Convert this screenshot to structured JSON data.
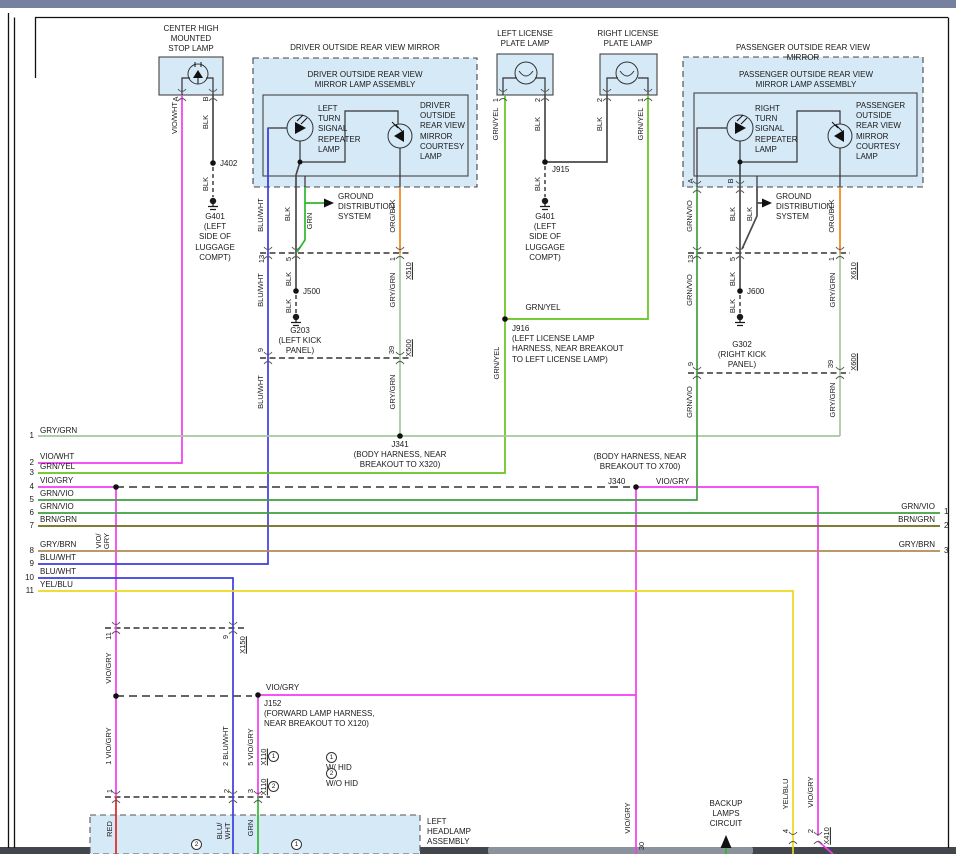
{
  "window": {
    "top_bar_color": "#76819f",
    "bottom_bar_color": "#42474e",
    "bottom_thumb_color": "#8b939d"
  },
  "colors": {
    "box_fill": "#d6e9f7",
    "box_border": "#444444"
  },
  "wire_colors": {
    "vio": "#f23cf2",
    "blk": "#4a4a4a",
    "blu_wht": "#3c3ce0",
    "grn": "#2eb82e",
    "grn_yel": "#64c41c",
    "gry_grn": "#a6c79e",
    "grn_vio": "#3f9f3f",
    "brn_grn": "#6b6b14",
    "gry_brn": "#b08a55",
    "yel_blu": "#ecd919",
    "org_blk": "#ef8318",
    "red": "#e32222",
    "dashed": "#333333",
    "internal": "#333333"
  },
  "components": {
    "chmsl_title": "CENTER HIGH\nMOUNTED\nSTOP LAMP",
    "driver_mirror_title": "DRIVER OUTSIDE REAR VIEW MIRROR",
    "driver_assembly_title": "DRIVER OUTSIDE REAR VIEW\nMIRROR LAMP ASSEMBLY",
    "left_turn_lamp": "LEFT\nTURN\nSIGNAL\nREPEATER\nLAMP",
    "driver_courtesy_lamp": "DRIVER\nOUTSIDE\nREAR VIEW\nMIRROR\nCOURTESY\nLAMP",
    "passenger_mirror_title": "PASSENGER OUTSIDE REAR VIEW MIRROR",
    "passenger_assembly_title": "PASSENGER OUTSIDE REAR VIEW\nMIRROR LAMP ASSEMBLY",
    "right_turn_lamp": "RIGHT\nTURN\nSIGNAL\nREPEATER\nLAMP",
    "passenger_courtesy_lamp": "PASSENGER\nOUTSIDE\nREAR VIEW\nMIRROR\nCOURTESY\nLAMP",
    "left_license_title": "LEFT LICENSE\nPLATE LAMP",
    "right_license_title": "RIGHT LICENSE\nPLATE LAMP",
    "left_headlamp_title": "LEFT\nHEADLAMP\nASSEMBLY",
    "backup_lamps": "BACKUP\nLAMPS\nCIRCUIT",
    "ground_distribution": "GROUND\nDISTRIBUTION\nSYSTEM"
  },
  "grounds": {
    "g401": "G401\n(LEFT\nSIDE OF\nLUGGAGE\nCOMPT)",
    "g203": "G203\n(LEFT KICK\nPANEL)",
    "g302": "G302\n(RIGHT KICK\nPANEL)"
  },
  "junctions": {
    "j402": "J402",
    "j915": "J915",
    "j500": "J500",
    "j600": "J600",
    "j916": "J916\n(LEFT LICENSE LAMP\nHARNESS, NEAR BREAKOUT\nTO LEFT LICENSE LAMP)",
    "j341": "J341\n(BODY HARNESS, NEAR\nBREAKOUT TO X320)",
    "j340_note": "(BODY HARNESS, NEAR\nBREAKOUT TO X700)",
    "j340": "J340",
    "j152": "J152\n(FORWARD LAMP HARNESS,\nNEAR BREAKOUT TO X120)"
  },
  "connectors": {
    "x510": "X510",
    "x500": "X500",
    "x610": "X610",
    "x600": "X600",
    "x150": "X150",
    "x110": "X110",
    "x410": "X410"
  },
  "wires": {
    "vio_wht": "VIO/WHT",
    "vio_gry": "VIO/GRY",
    "vio_gry_2l": "VIO/\nGRY",
    "blk": "BLK",
    "blu_wht": "BLU/WHT",
    "blu_wht_2l": "BLU/\nWHT",
    "grn": "GRN",
    "grn_yel": "GRN/YEL",
    "gry_grn": "GRY/GRN",
    "grn_vio": "GRN/VIO",
    "brn_grn": "BRN/GRN",
    "gry_brn": "GRY/BRN",
    "yel_blu": "YEL/BLU",
    "org_blk": "ORG/BLK",
    "red": "RED",
    "vio_gry_p1": "1  VIO/GRY",
    "blu_wht_p2": "2  BLU/WHT",
    "vio_gry_p5": "5  VIO/GRY"
  },
  "pins": {
    "a": "A",
    "b": "B",
    "p1": "1",
    "p2": "2",
    "p3": "3",
    "p4": "4",
    "p5": "5",
    "p9": "9",
    "p11": "11",
    "p13": "13",
    "p30": "30",
    "p39": "39"
  },
  "left_bus": [
    {
      "n": "1",
      "label": "GRY/GRN"
    },
    {
      "n": "2",
      "label": "VIO/WHT"
    },
    {
      "n": "3",
      "label": "GRN/YEL"
    },
    {
      "n": "4",
      "label": "VIO/GRY"
    },
    {
      "n": "5",
      "label": "GRN/VIO"
    },
    {
      "n": "6",
      "label": "GRN/VIO"
    },
    {
      "n": "7",
      "label": "BRN/GRN"
    },
    {
      "n": "8",
      "label": "GRY/BRN"
    },
    {
      "n": "9",
      "label": "BLU/WHT"
    },
    {
      "n": "10",
      "label": "BLU/WHT"
    },
    {
      "n": "11",
      "label": "YEL/BLU"
    }
  ],
  "right_bus": [
    {
      "n": "1",
      "label": "GRN/VIO"
    },
    {
      "n": "2",
      "label": "BRN/GRN"
    },
    {
      "n": "3",
      "label": "GRY/BRN"
    }
  ],
  "notes": {
    "c1": "1",
    "c2": "2",
    "hid_with": "W/ HID",
    "hid_without": "W/O HID"
  }
}
